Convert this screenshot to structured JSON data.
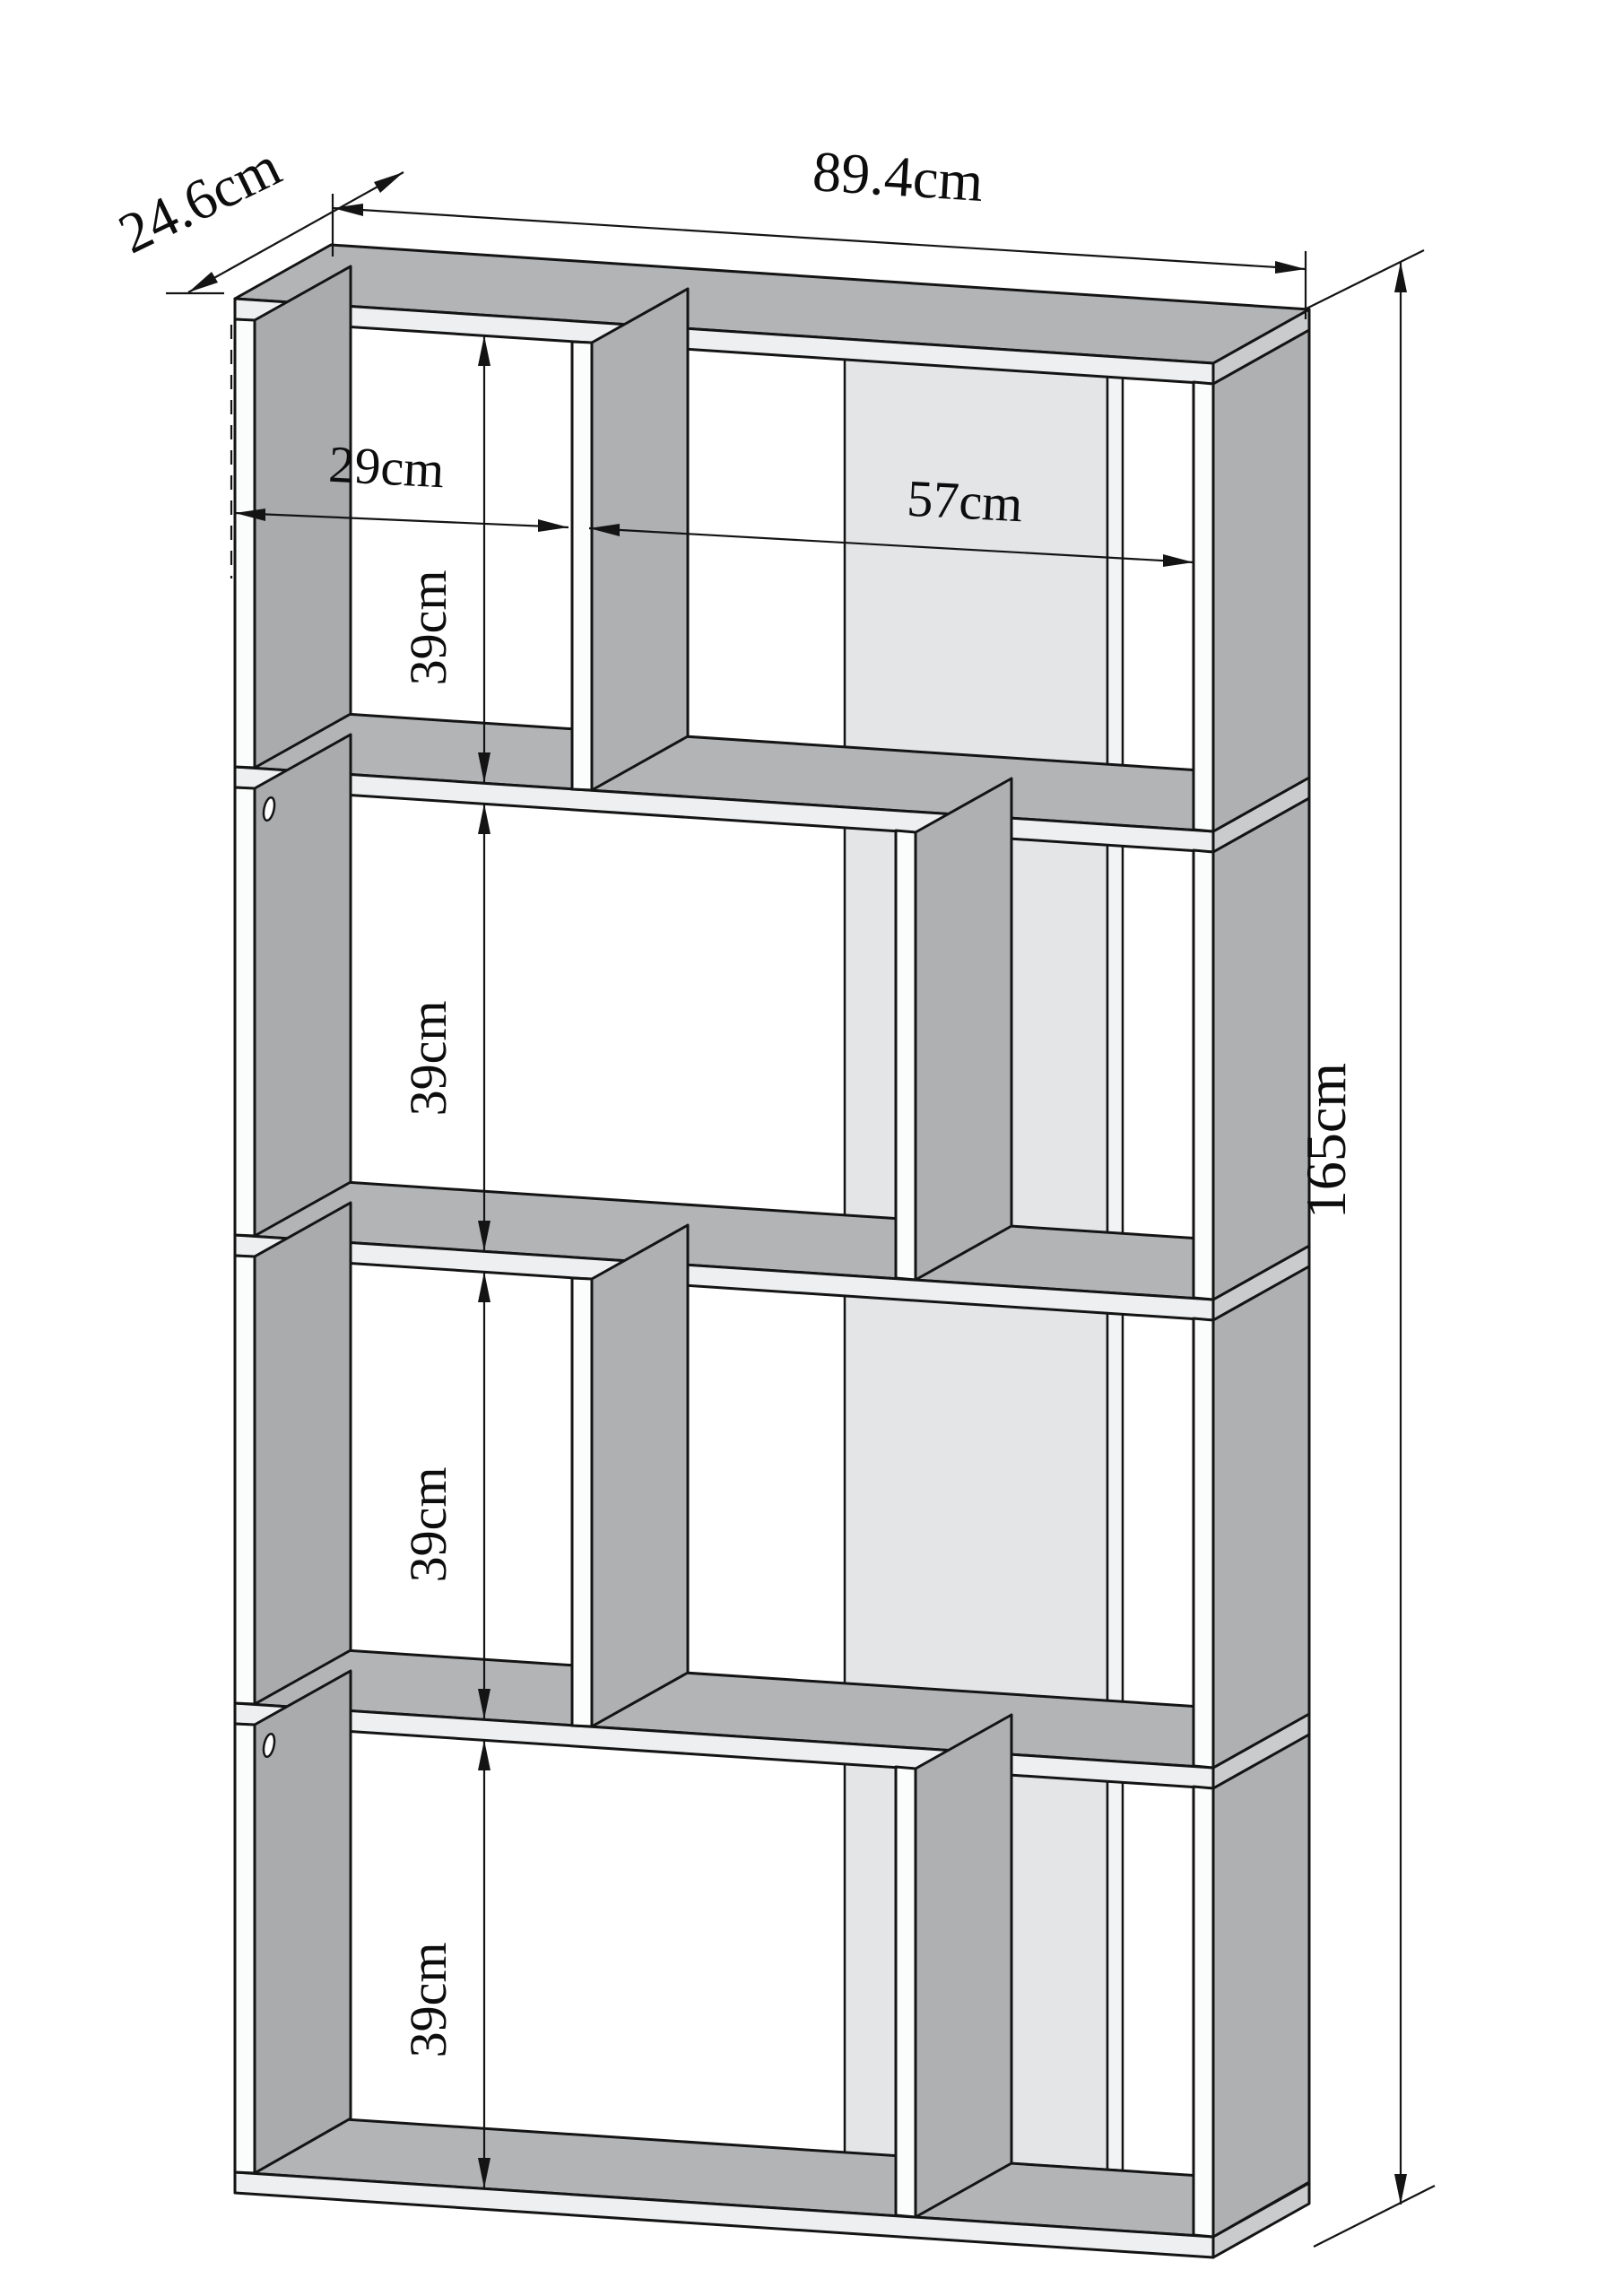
{
  "diagram": {
    "kind": "furniture dimension drawing",
    "subject": "4-tier S-shaped zigzag bookcase, perspective line drawing with dimension annotations",
    "units": "cm",
    "dims": {
      "overall_width": "89.4cm",
      "overall_depth": "24.6cm",
      "overall_height": "165cm",
      "left_compartment_width": "29cm",
      "right_compartment_width": "57cm",
      "tier_heights": [
        "39cm",
        "39cm",
        "39cm",
        "39cm"
      ]
    },
    "features": {
      "shelf_count": 5,
      "tier_count": 4,
      "assembly_holes": 2
    },
    "colors": {
      "background": "#ffffff",
      "line": "#141414",
      "top_face_gray": "#b2b4b6",
      "panel_side_gray": "#aeb0b2",
      "back_strip_gray": "#e3e5e7",
      "slab_front_light": "#edeff0"
    }
  }
}
